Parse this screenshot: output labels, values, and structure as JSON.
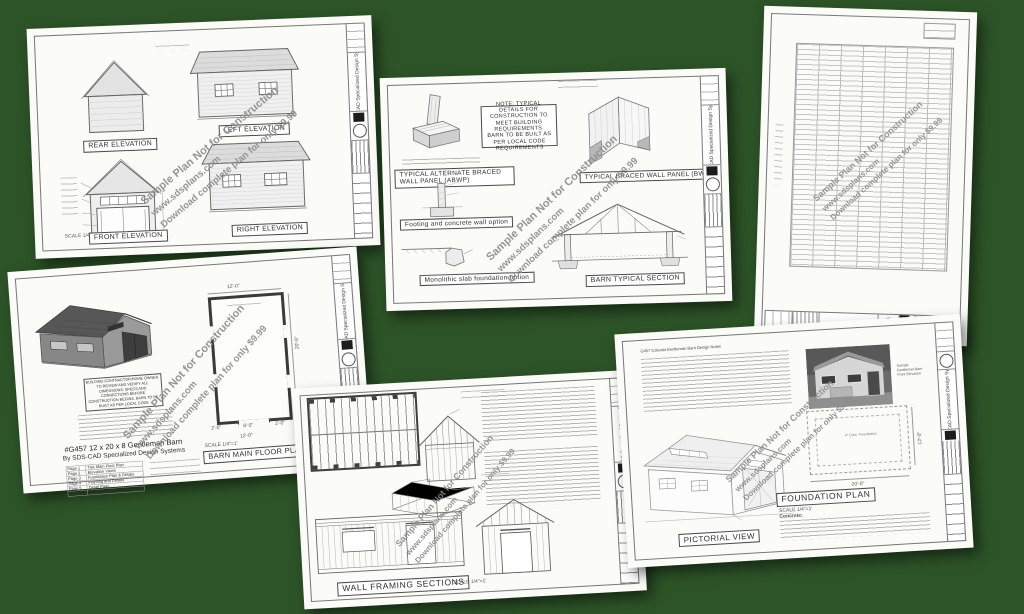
{
  "background": "#2d5328",
  "brand": {
    "name": "SDS-CAD Specialized Design Systems"
  },
  "watermark": {
    "line1": "Sample Plan Not for Construction",
    "line2": "www.sdsplans.com",
    "line3": "Download complete plan for only $9.99"
  },
  "common": {
    "scale_label": "SCALE 1/4\"=1'"
  },
  "sheet_elevations": {
    "rear": "REAR ELEVATION",
    "left": "LEFT ELEVATION",
    "front": "FRONT ELEVATION",
    "right": "RIGHT ELEVATION"
  },
  "sheet_details": {
    "note": "NOTE: TYPICAL DETAILS FOR CONSTRUCTION TO MEET BUILDING REQUIREMENTS. BARN TO BE BUILT AS PER LOCAL CODE REQUIREMENTS",
    "abwp": "TYPICAL ALTERNATE BRACED WALL PANEL (ABWP)",
    "bwp": "TYPICAL BRACED WALL PANEL (BWP)",
    "footing": "Footing and concrete wall option",
    "slab": "Monolithic slab foundation option",
    "section": "BARN TYPICAL SECTION"
  },
  "sheet_plan": {
    "disclaimer": "BUILDING CONTRACTOR/HOME OWNER TO REVIEW AND VERIFY ALL DIMENSIONS, SPECS AND CONNECTIONS BEFORE CONSTRUCTION BEGINS. BARN TO BE BUILT AS PER LOCAL CODE REQUIREMENTS",
    "model": "#G457 12 x 20 x 8 Gentleman Barn",
    "byline": "By SDS-CAD Specialized Design Systems",
    "plan_label": "BARN MAIN FLOOR PLAN",
    "pages": [
      {
        "page": "Page 1",
        "label": "Title Main Floor Plan"
      },
      {
        "page": "Page 2",
        "label": "Elevation Views"
      },
      {
        "page": "Page 3",
        "label": "Foundation Plan & Details"
      },
      {
        "page": "Page 4",
        "label": "Framing and Details"
      },
      {
        "page": "Page 5",
        "label": "Detail Page"
      },
      {
        "page": "Page 6",
        "label": "Materials List"
      }
    ],
    "dim_top": "12'-0\"",
    "dim_bottom": "12'-0\"",
    "dim_seg_left": "2'-0\"",
    "dim_seg_mid": "8'-0\"",
    "dim_seg_right": "2'-0\"",
    "dim_right": "20'-0\""
  },
  "sheet_framing": {
    "label": "WALL FRAMING SECTIONS"
  },
  "sheet_foundation": {
    "notes_title": "G457 Colonial Gentleman Barn Design Notes",
    "foundation_label": "FOUNDATION PLAN",
    "pictorial_label": "PICTORIAL VIEW",
    "concrete": "Concrete:",
    "slab_text": "4\" Conc. Foundation",
    "dim_bottom": "20'-0\"",
    "dim_right": "12'-0\"",
    "photo_caption": [
      "Sample",
      "Gentleman Barn",
      "Front Elevation"
    ]
  }
}
